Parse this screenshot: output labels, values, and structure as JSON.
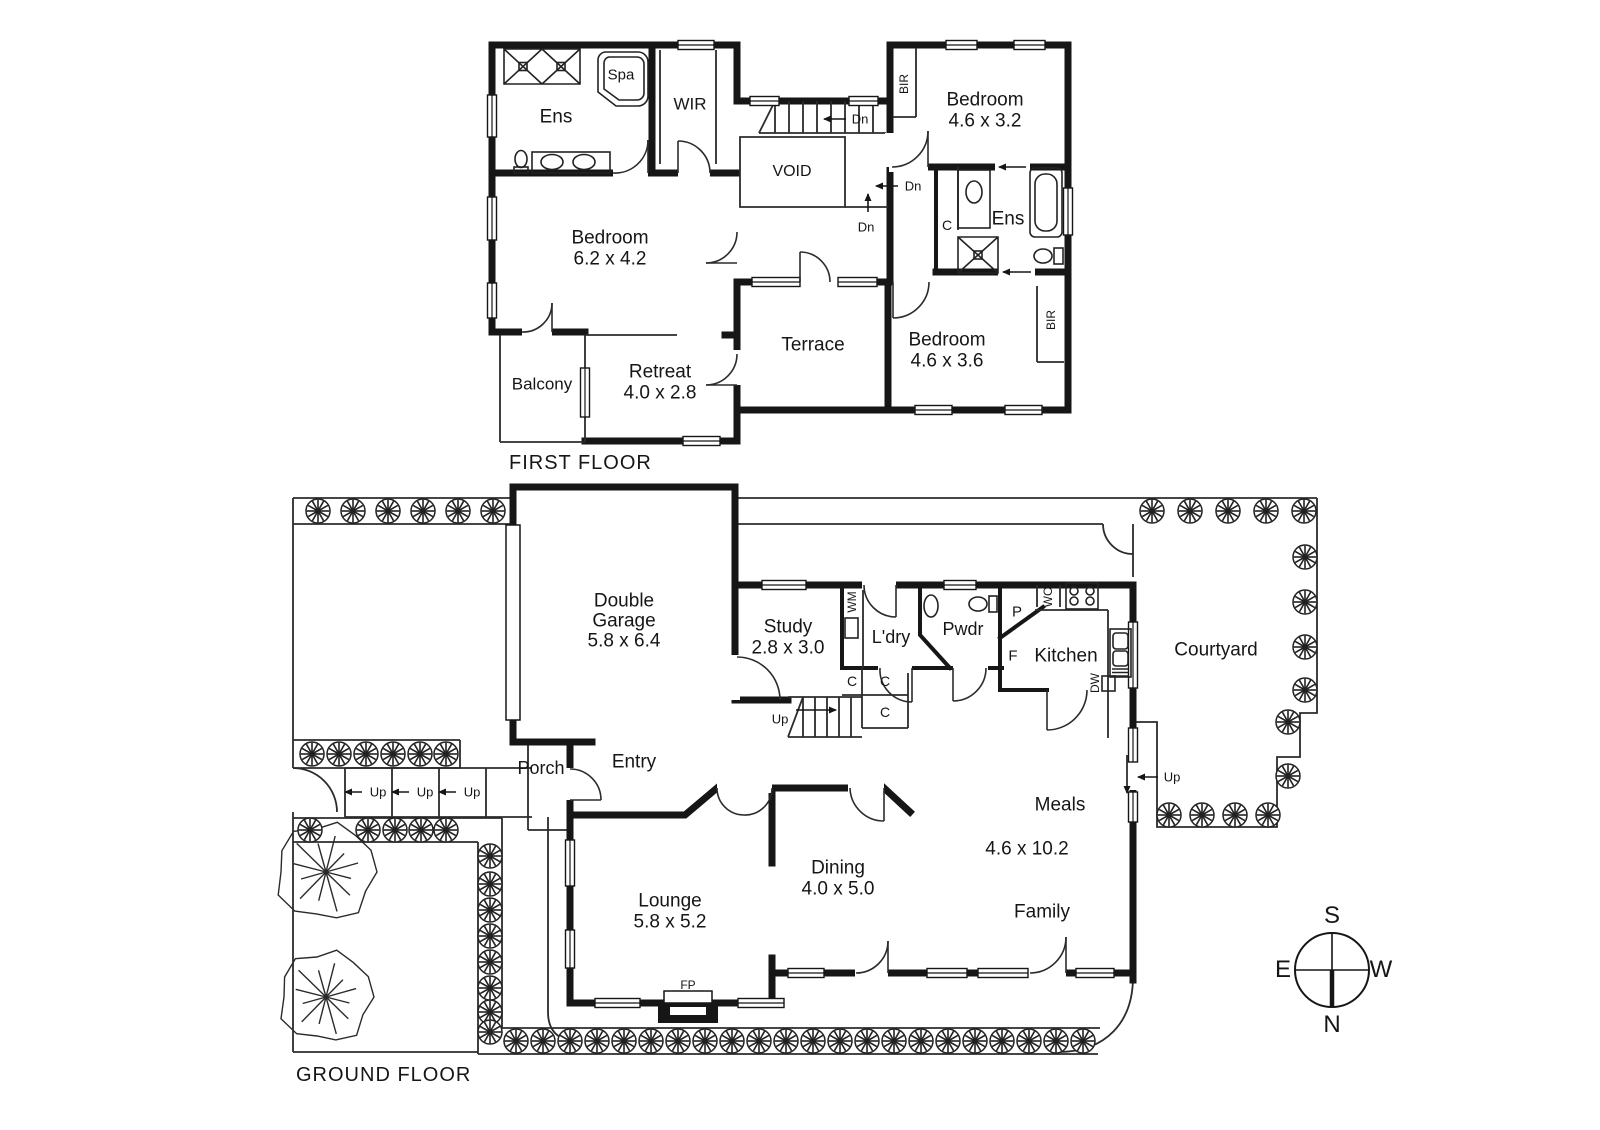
{
  "document": {
    "kind": "real-estate floor plan",
    "floor_count": 2
  },
  "colors": {
    "wall": "#161616",
    "thin_line": "#2b2b2b",
    "text": "#161616",
    "background": "#ffffff"
  },
  "floors": [
    {
      "name": "first-floor",
      "title": "FIRST FLOOR",
      "title_pos": [
        509,
        463
      ],
      "labels": [
        {
          "id": "ens-1",
          "text": "Ens",
          "x": 556,
          "y": 117,
          "size": 19
        },
        {
          "id": "spa",
          "text": "Spa",
          "x": 621,
          "y": 75,
          "size": 15
        },
        {
          "id": "wir",
          "text": "WIR",
          "x": 690,
          "y": 104,
          "size": 17
        },
        {
          "id": "bedroom-main",
          "text": "Bedroom",
          "x": 610,
          "y": 238,
          "size": 19
        },
        {
          "id": "bedroom-main-dims",
          "text": "6.2 x 4.2",
          "x": 610,
          "y": 259,
          "size": 19
        },
        {
          "id": "balcony",
          "text": "Balcony",
          "x": 542,
          "y": 384,
          "size": 17
        },
        {
          "id": "retreat",
          "text": "Retreat",
          "x": 660,
          "y": 372,
          "size": 19
        },
        {
          "id": "retreat-dims",
          "text": "4.0 x 2.8",
          "x": 660,
          "y": 393,
          "size": 19
        },
        {
          "id": "terrace",
          "text": "Terrace",
          "x": 813,
          "y": 345,
          "size": 19
        },
        {
          "id": "void",
          "text": "VOID",
          "x": 792,
          "y": 172,
          "size": 16
        },
        {
          "id": "bedroom-2",
          "text": "Bedroom",
          "x": 985,
          "y": 100,
          "size": 19
        },
        {
          "id": "bedroom-2-dims",
          "text": "4.6 x 3.2",
          "x": 985,
          "y": 121,
          "size": 19
        },
        {
          "id": "ens-2",
          "text": "Ens",
          "x": 1008,
          "y": 219,
          "size": 19
        },
        {
          "id": "bedroom-3",
          "text": "Bedroom",
          "x": 947,
          "y": 340,
          "size": 19
        },
        {
          "id": "bedroom-3-dims",
          "text": "4.6 x 3.6",
          "x": 947,
          "y": 361,
          "size": 19
        },
        {
          "id": "bir-1",
          "text": "BIR",
          "x": 904,
          "y": 84,
          "size": 12,
          "rotate": -90
        },
        {
          "id": "bir-2",
          "text": "BIR",
          "x": 1051,
          "y": 320,
          "size": 12,
          "rotate": -90
        },
        {
          "id": "closet-c1",
          "text": "C",
          "x": 947,
          "y": 225,
          "size": 14
        },
        {
          "id": "dn-1",
          "text": "Dn",
          "x": 860,
          "y": 119,
          "size": 13
        },
        {
          "id": "dn-2",
          "text": "Dn",
          "x": 913,
          "y": 186,
          "size": 13
        },
        {
          "id": "dn-3",
          "text": "Dn",
          "x": 866,
          "y": 227,
          "size": 13
        }
      ]
    },
    {
      "name": "ground-floor",
      "title": "GROUND FLOOR",
      "title_pos": [
        296,
        1075
      ],
      "labels": [
        {
          "id": "garage-1",
          "text": "Double",
          "x": 624,
          "y": 601,
          "size": 19
        },
        {
          "id": "garage-2",
          "text": "Garage",
          "x": 624,
          "y": 621,
          "size": 19
        },
        {
          "id": "garage-dims",
          "text": "5.8 x 6.4",
          "x": 624,
          "y": 641,
          "size": 19
        },
        {
          "id": "study",
          "text": "Study",
          "x": 788,
          "y": 627,
          "size": 19
        },
        {
          "id": "study-dims",
          "text": "2.8 x 3.0",
          "x": 788,
          "y": 648,
          "size": 19
        },
        {
          "id": "wm",
          "text": "WM",
          "x": 852,
          "y": 602,
          "size": 12,
          "rotate": -90
        },
        {
          "id": "ldry",
          "text": "L'dry",
          "x": 891,
          "y": 637,
          "size": 18
        },
        {
          "id": "pwdr",
          "text": "Pwdr",
          "x": 963,
          "y": 629,
          "size": 18
        },
        {
          "id": "pantry-p",
          "text": "P",
          "x": 1017,
          "y": 612,
          "size": 15
        },
        {
          "id": "wo",
          "text": "WO",
          "x": 1048,
          "y": 597,
          "size": 12,
          "rotate": -90
        },
        {
          "id": "fridge-f",
          "text": "F",
          "x": 1013,
          "y": 656,
          "size": 15
        },
        {
          "id": "kitchen",
          "text": "Kitchen",
          "x": 1066,
          "y": 656,
          "size": 19
        },
        {
          "id": "dw",
          "text": "DW",
          "x": 1095,
          "y": 683,
          "size": 12,
          "rotate": -90
        },
        {
          "id": "closet-g1",
          "text": "C",
          "x": 852,
          "y": 681,
          "size": 14
        },
        {
          "id": "closet-g2",
          "text": "C",
          "x": 885,
          "y": 681,
          "size": 14
        },
        {
          "id": "closet-g3",
          "text": "C",
          "x": 885,
          "y": 712,
          "size": 14
        },
        {
          "id": "up-internal",
          "text": "Up",
          "x": 780,
          "y": 719,
          "size": 13
        },
        {
          "id": "porch",
          "text": "Porch",
          "x": 541,
          "y": 768,
          "size": 18
        },
        {
          "id": "entry",
          "text": "Entry",
          "x": 634,
          "y": 762,
          "size": 19
        },
        {
          "id": "up-step-1",
          "text": "Up",
          "x": 378,
          "y": 792,
          "size": 13
        },
        {
          "id": "up-step-2",
          "text": "Up",
          "x": 425,
          "y": 792,
          "size": 13
        },
        {
          "id": "up-step-3",
          "text": "Up",
          "x": 472,
          "y": 792,
          "size": 13
        },
        {
          "id": "lounge",
          "text": "Lounge",
          "x": 670,
          "y": 901,
          "size": 19
        },
        {
          "id": "lounge-dims",
          "text": "5.8 x 5.2",
          "x": 670,
          "y": 922,
          "size": 19
        },
        {
          "id": "dining",
          "text": "Dining",
          "x": 838,
          "y": 868,
          "size": 19
        },
        {
          "id": "dining-dims",
          "text": "4.0 x 5.0",
          "x": 838,
          "y": 889,
          "size": 19
        },
        {
          "id": "meals",
          "text": "Meals",
          "x": 1060,
          "y": 805,
          "size": 19
        },
        {
          "id": "meals-dims",
          "text": "4.6 x 10.2",
          "x": 1027,
          "y": 849,
          "size": 19
        },
        {
          "id": "family",
          "text": "Family",
          "x": 1042,
          "y": 912,
          "size": 19
        },
        {
          "id": "fp",
          "text": "FP",
          "x": 688,
          "y": 985,
          "size": 12
        },
        {
          "id": "courtyard",
          "text": "Courtyard",
          "x": 1216,
          "y": 650,
          "size": 19
        },
        {
          "id": "up-courtyard",
          "text": "Up",
          "x": 1172,
          "y": 777,
          "size": 13
        }
      ]
    }
  ],
  "compass": {
    "cx": 1332,
    "cy": 970,
    "n": "N",
    "s": "S",
    "e": "E",
    "w": "W"
  }
}
